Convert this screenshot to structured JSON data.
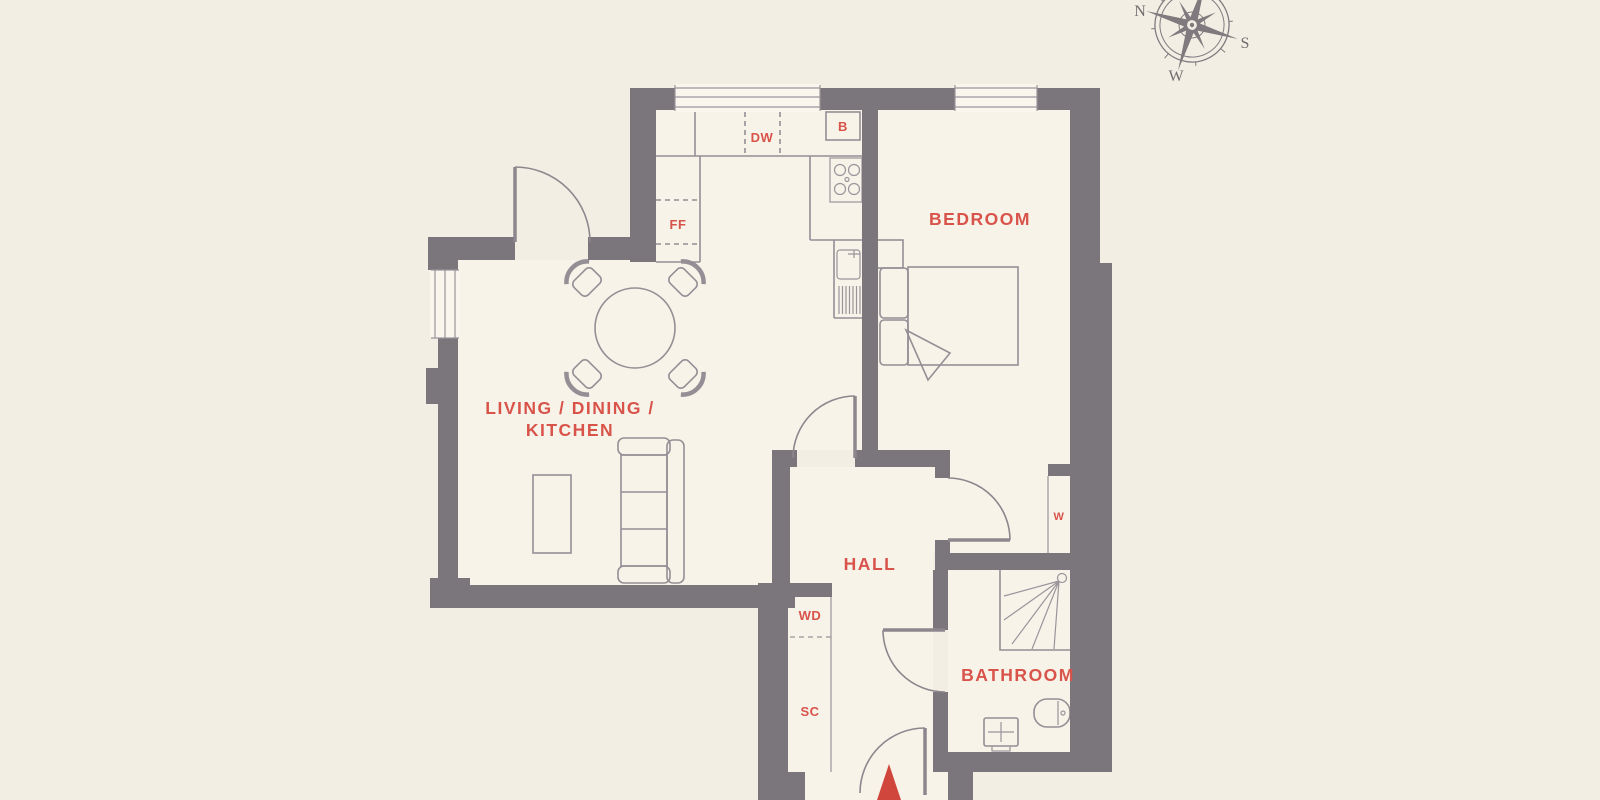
{
  "floorplan": {
    "rooms": {
      "living_line1": "LIVING / DINING /",
      "living_line2": "KITCHEN",
      "bedroom": "BEDROOM",
      "hall": "HALL",
      "bathroom": "BATHROOM"
    },
    "fixtures": {
      "dishwasher": "DW",
      "boiler": "B",
      "fridge_freezer": "FF",
      "wardrobe": "W",
      "washer_dryer": "WD",
      "storage_cupboard": "SC"
    },
    "compass": {
      "north": "N",
      "south": "S",
      "west": "W"
    },
    "colors": {
      "background": "#f3eee3",
      "wall": "#7b757c",
      "furniture_line": "#948f95",
      "label": "#d8544b",
      "window_fill": "#faf6ed"
    }
  }
}
